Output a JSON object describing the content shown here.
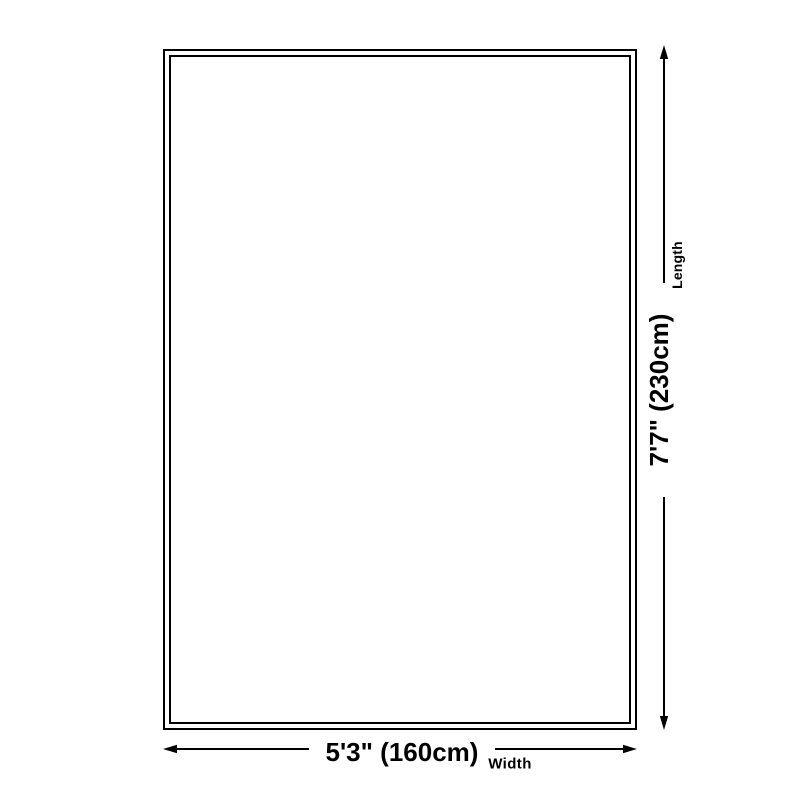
{
  "colors": {
    "line": "#000000",
    "background": "#ffffff"
  },
  "diagram": {
    "length": {
      "value": "7'7\" (230cm)",
      "label": "Length"
    },
    "width": {
      "value": "5'3\" (160cm)",
      "label": "Width"
    }
  }
}
